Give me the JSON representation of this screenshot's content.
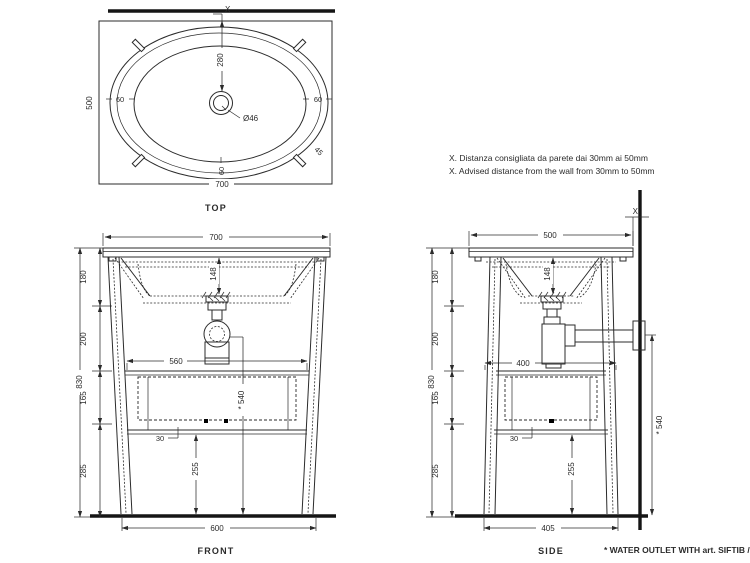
{
  "notes": {
    "wall_distance_it": "X. Distanza consigliata da parete dai 30mm ai 50mm",
    "wall_distance_en": "X. Advised distance from the wall from 30mm to 50mm",
    "water_outlet": "* WATER OUTLET WITH art. SIFTIB / SIFN"
  },
  "views": {
    "top": {
      "label": "TOP",
      "wall_mark": "X",
      "width": "700",
      "depth": "500",
      "drain_offset": "280",
      "drain_diameter": "Ø46",
      "rim_left": "60",
      "rim_right": "60",
      "rim_bottom": "60",
      "tap_angle": "45"
    },
    "front": {
      "label": "FRONT",
      "top_width": "700",
      "basin_depth": "148",
      "seg_1": "180",
      "seg_2": "200",
      "seg_3": "165",
      "seg_4": "285",
      "overall_height": "830",
      "shelf_width": "560",
      "shelf_inset": "30",
      "clearance": "255",
      "outlet_height": "* 540",
      "feet_width": "600"
    },
    "side": {
      "label": "SIDE",
      "wall_mark": "X",
      "top_depth": "500",
      "basin_depth": "148",
      "seg_1": "180",
      "seg_2": "200",
      "seg_3": "165",
      "seg_4": "285",
      "overall_height": "830",
      "shelf_depth": "400",
      "shelf_inset": "30",
      "clearance": "255",
      "outlet_height": "* 540",
      "feet_depth": "405"
    }
  }
}
